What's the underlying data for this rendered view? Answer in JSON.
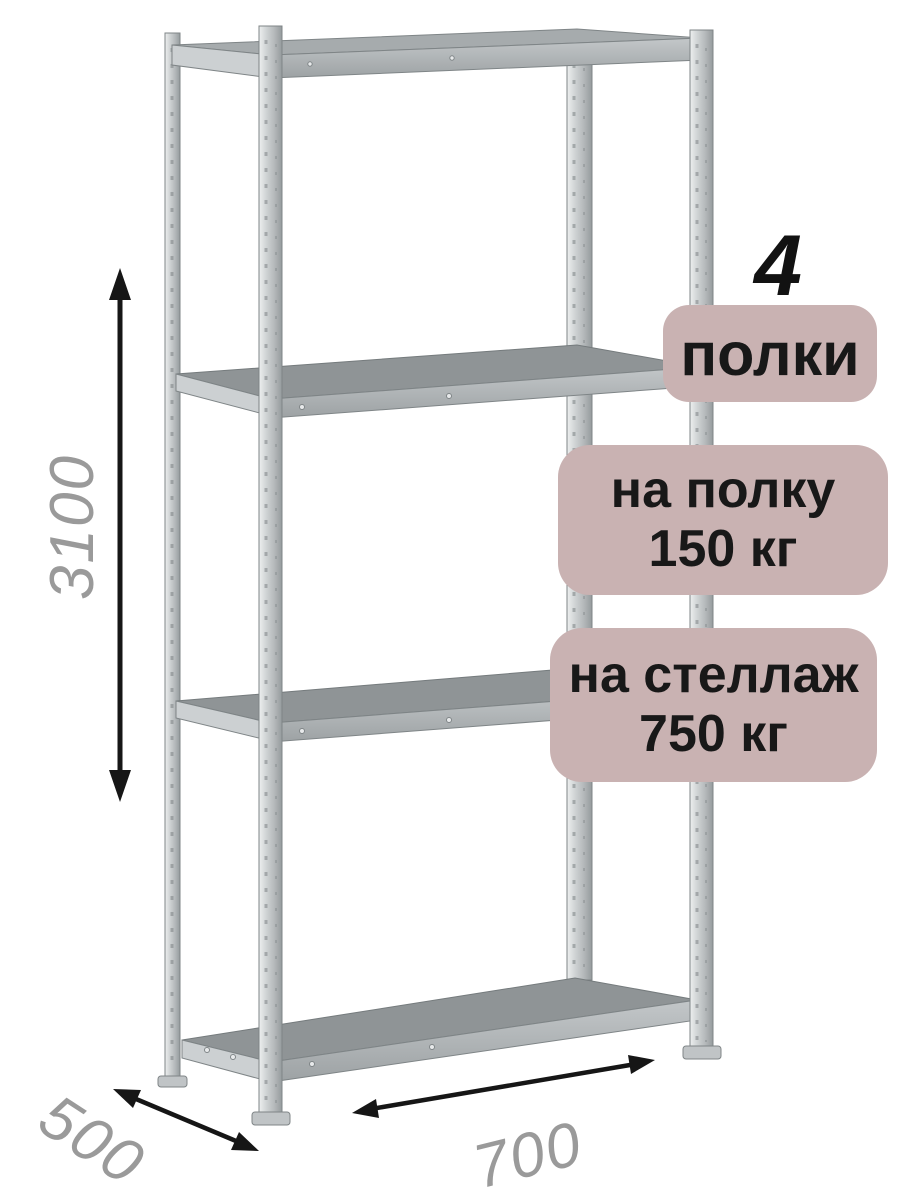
{
  "product": {
    "shelf_count": {
      "value": "4",
      "label": "полки"
    },
    "shelf_load": {
      "line1": "на полку",
      "line2": "150 кг"
    },
    "rack_load": {
      "line1": "на стеллаж",
      "line2": "750 кг"
    },
    "dimensions": {
      "height_mm": "3100",
      "depth_mm": "500",
      "width_mm": "700"
    }
  },
  "colors": {
    "badge_bg": "#c9b2b2",
    "badge_text": "#181818",
    "dimension_text": "#9a9a9a",
    "arrow": "#161616",
    "shelf_top": "#8f9496",
    "frame_light": "#e9ebeb",
    "frame_mid": "#c7cbcd",
    "frame_dark": "#9aa0a2"
  }
}
